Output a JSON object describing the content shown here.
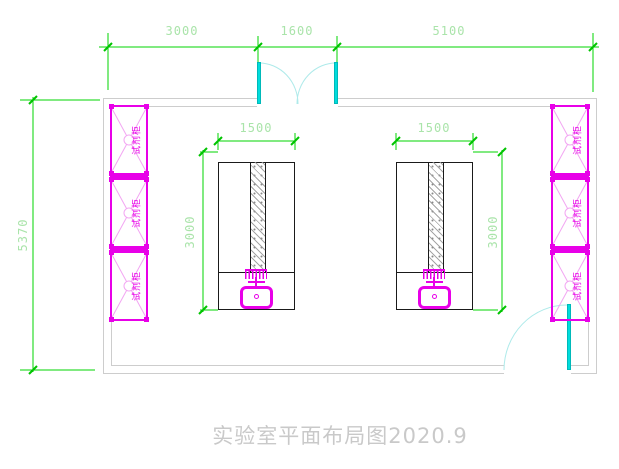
{
  "drawing": {
    "title": "实验室平面布局图2020.9"
  },
  "dimensions": {
    "top": [
      "3000",
      "1600",
      "5100"
    ],
    "room_height": "5370",
    "bench_width": "1500",
    "bench_length": "3000"
  },
  "cabinets": {
    "label": "试剂柜",
    "left_count": 3,
    "right_count": 3
  },
  "colors": {
    "dimension_line": "#00d400",
    "dimension_text": "#aae4aa",
    "wall": "#cdcdcd",
    "cabinet": "#e800e8",
    "cabinet_accent": "#f2a6f2",
    "door": "#00dcdc",
    "door_swing": "#aeeaea",
    "bench_outline": "#1a1a1a",
    "title_text": "#c9c9c9",
    "background": "#ffffff"
  }
}
